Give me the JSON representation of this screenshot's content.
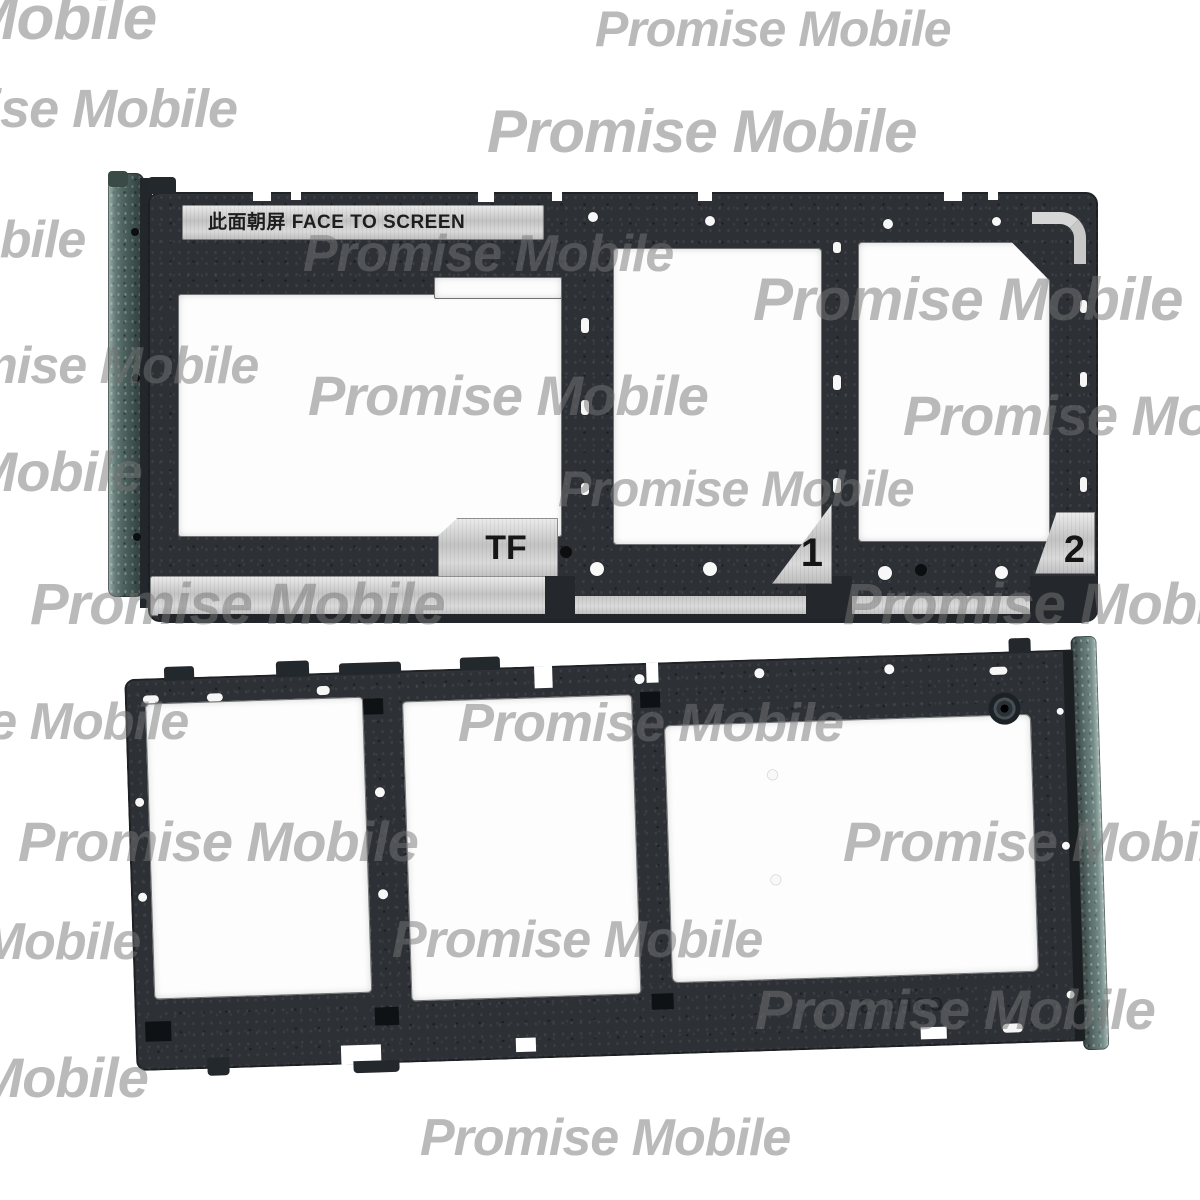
{
  "watermark": {
    "text": "Promise Mobile"
  },
  "top_tray": {
    "face_label": "此面朝屏  FACE TO SCREEN",
    "tf_label": "TF",
    "sim1_label": "1",
    "sim2_label": "2"
  },
  "bottom_tray": {
    "embossed_code": "C9H1-2"
  },
  "colors": {
    "background": "#ffffff",
    "frame_dark": "#2d3136",
    "cap_teal": "#556964",
    "silver": "#cdcdcd",
    "watermark": "#bcbcbc"
  }
}
